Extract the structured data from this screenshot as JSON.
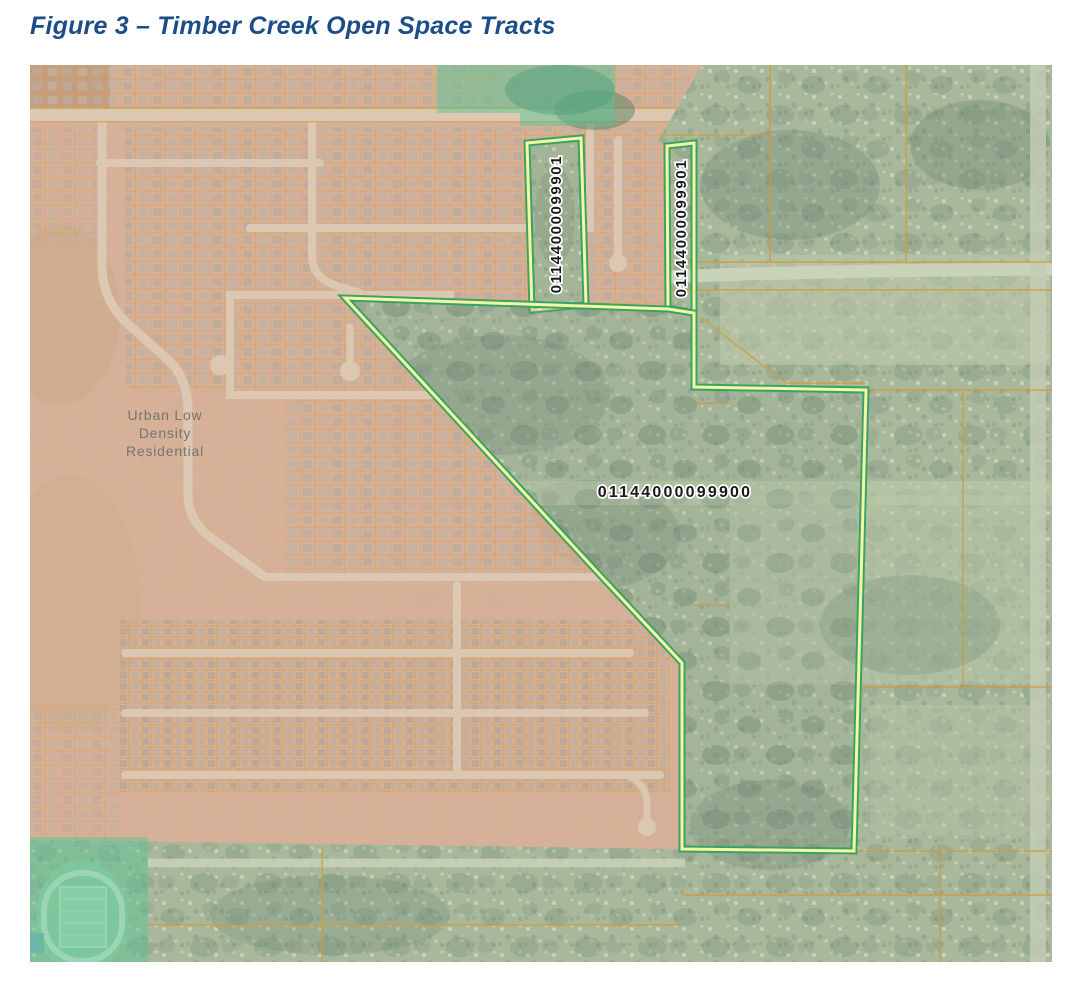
{
  "figure": {
    "title": "Figure 3 – Timber Creek Open Space Tracts",
    "title_color": "#1d4d87"
  },
  "map": {
    "type": "aerial-parcel-map",
    "zoning_label": {
      "line1": "Urban Low",
      "line2": "Density",
      "line3": "Residential",
      "color": "#75756f"
    },
    "parcel_labels": {
      "left_strip": "01144000099901",
      "right_strip": "01144000099901",
      "main_tract": "01144000099900"
    },
    "colors": {
      "urban_overlay": "#d9b098",
      "forest_base": "#a9b89b",
      "open_space_highlight": "#57c695",
      "tract_outline_green": "#35a163",
      "tract_outline_yellow": "#f4f6a6",
      "parcel_line_orange": "#d09a3e",
      "road_light": "#dcc8b2"
    }
  }
}
